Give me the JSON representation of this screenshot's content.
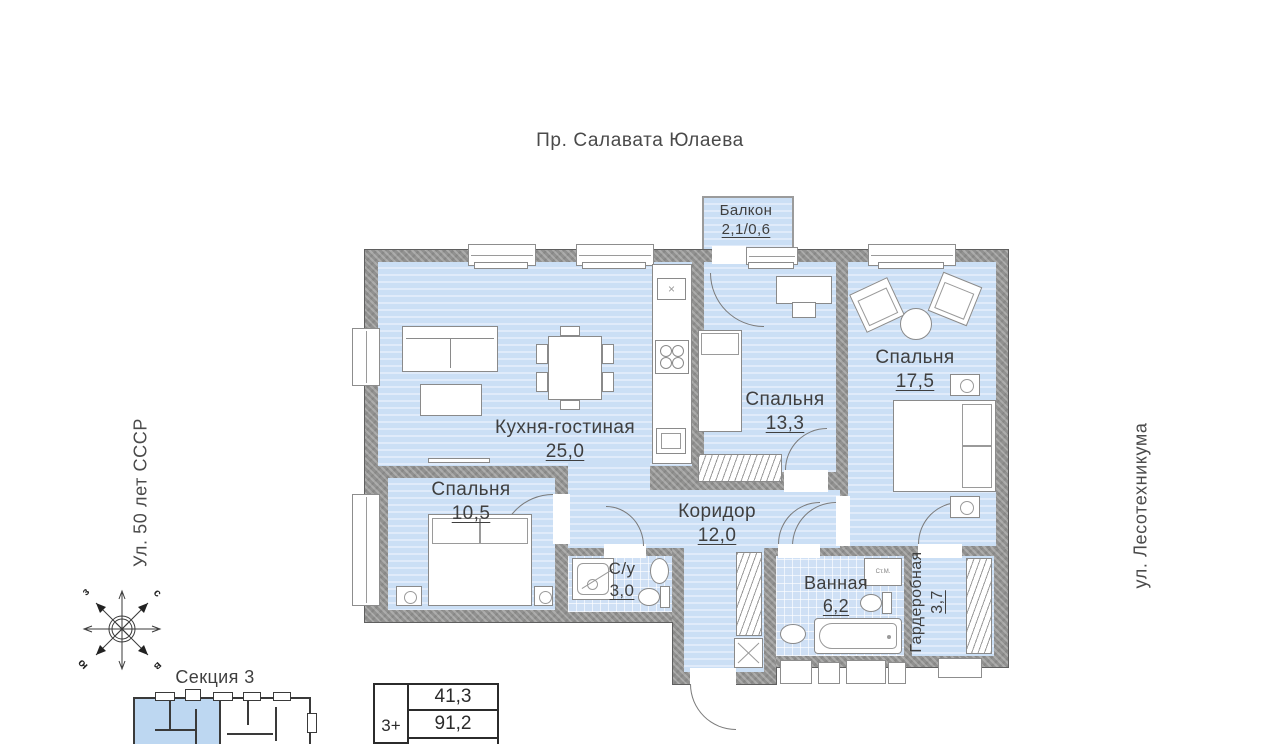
{
  "streets": {
    "top": "Пр. Салавата Юлаева",
    "left": "Ул. 50 лет СССР",
    "right": "ул. Лесотехникума"
  },
  "plan": {
    "rooms": {
      "balcony": {
        "name": "Балкон",
        "area": "2,1/0,6"
      },
      "kitchen_living": {
        "name": "Кухня-гостиная",
        "area": "25,0"
      },
      "bedroom_13": {
        "name": "Спальня",
        "area": "13,3"
      },
      "bedroom_17": {
        "name": "Спальня",
        "area": "17,5"
      },
      "bedroom_10": {
        "name": "Спальня",
        "area": "10,5"
      },
      "corridor": {
        "name": "Коридор",
        "area": "12,0"
      },
      "wc": {
        "name": "С/у",
        "area": "3,0"
      },
      "bathroom": {
        "name": "Ванная",
        "area": "6,2"
      },
      "wardrobe": {
        "name": "Гардеробная",
        "area": "3,7"
      }
    },
    "labels": {
      "washing_machine": "Ст.М."
    }
  },
  "icons": {
    "sink_cross": "×"
  },
  "compass": {
    "west": "з",
    "north": "с",
    "south": "ю",
    "east": "в"
  },
  "section": {
    "label": "Секция 3"
  },
  "info_table": {
    "type": "3+",
    "row1": "41,3",
    "row2": "91,2"
  },
  "colors": {
    "room_fill": "#cbdff5",
    "wall_gray": "#919190",
    "highlight_blue": "#bdd7f1"
  }
}
